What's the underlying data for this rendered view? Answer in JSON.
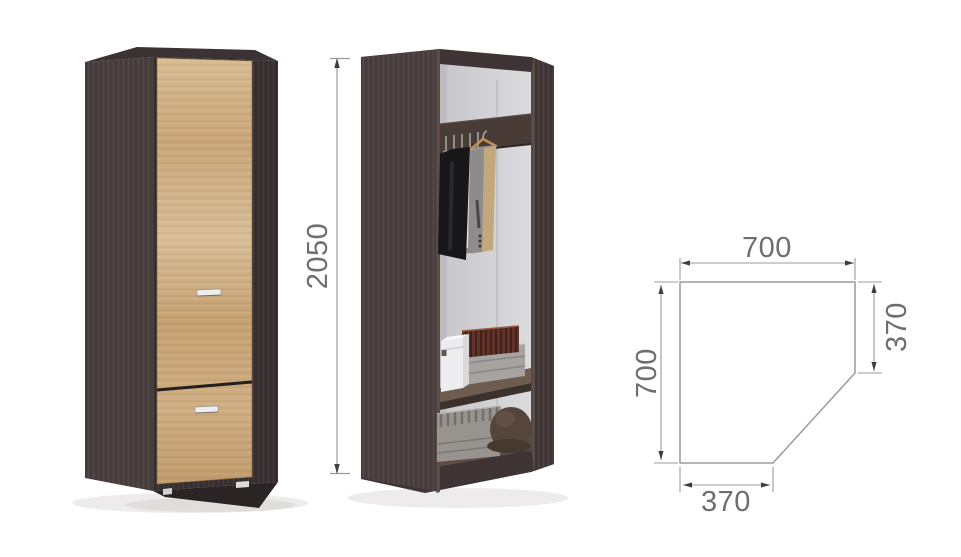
{
  "figure": {
    "background_color": "#ffffff",
    "wardrobe": {
      "body_color": "#453b3a",
      "door_color": "#cfae82",
      "interior_color": "#d4d4d7",
      "handle_color": "#eeeeec",
      "dimension_line_color": "#9b9b9b",
      "dimension_text_color": "#6e6e6e"
    },
    "dimensions": {
      "height": "2050",
      "plan_top_width": "700",
      "plan_right_depth": "370",
      "plan_left_side": "700",
      "plan_bottom_width": "370"
    }
  }
}
